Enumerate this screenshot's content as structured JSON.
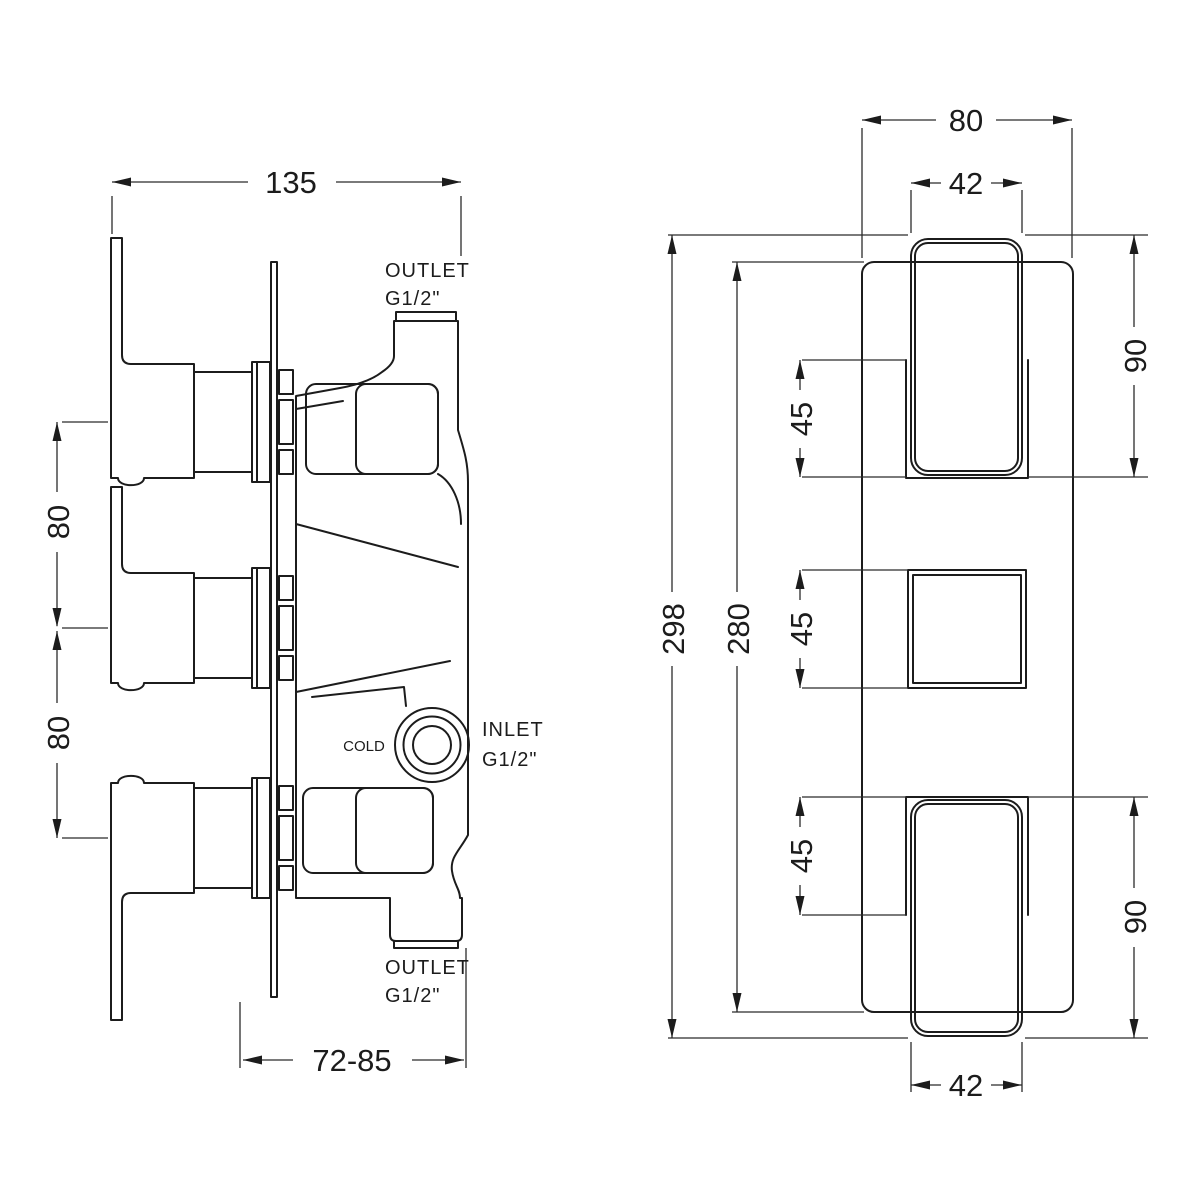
{
  "drawing_type": "thermostatic shower valve dimensional drawing",
  "side_view": {
    "dim_width": "135",
    "dim_pitch_upper": "80",
    "dim_pitch_lower": "80",
    "dim_depth_range": "72-85",
    "outlet_top": {
      "line1": "OUTLET",
      "line2": "G1/2\""
    },
    "inlet": {
      "line1": "INLET",
      "line2": "G1/2\""
    },
    "cold_label": "COLD",
    "outlet_bottom": {
      "line1": "OUTLET",
      "line2": "G1/2\""
    }
  },
  "front_view": {
    "dim_plate_width": "80",
    "dim_handle_width_top": "42",
    "dim_handle_width_bottom": "42",
    "dim_overall_height": "298",
    "dim_plate_height": "280",
    "dim_handle_height_top": "90",
    "dim_handle_height_bottom": "90",
    "dim_cartridge_top": "45",
    "dim_cartridge_middle": "45",
    "dim_cartridge_bottom": "45"
  },
  "colors": {
    "line": "#1c1c1c",
    "dim_line": "#2b2b2b",
    "background": "#ffffff"
  }
}
